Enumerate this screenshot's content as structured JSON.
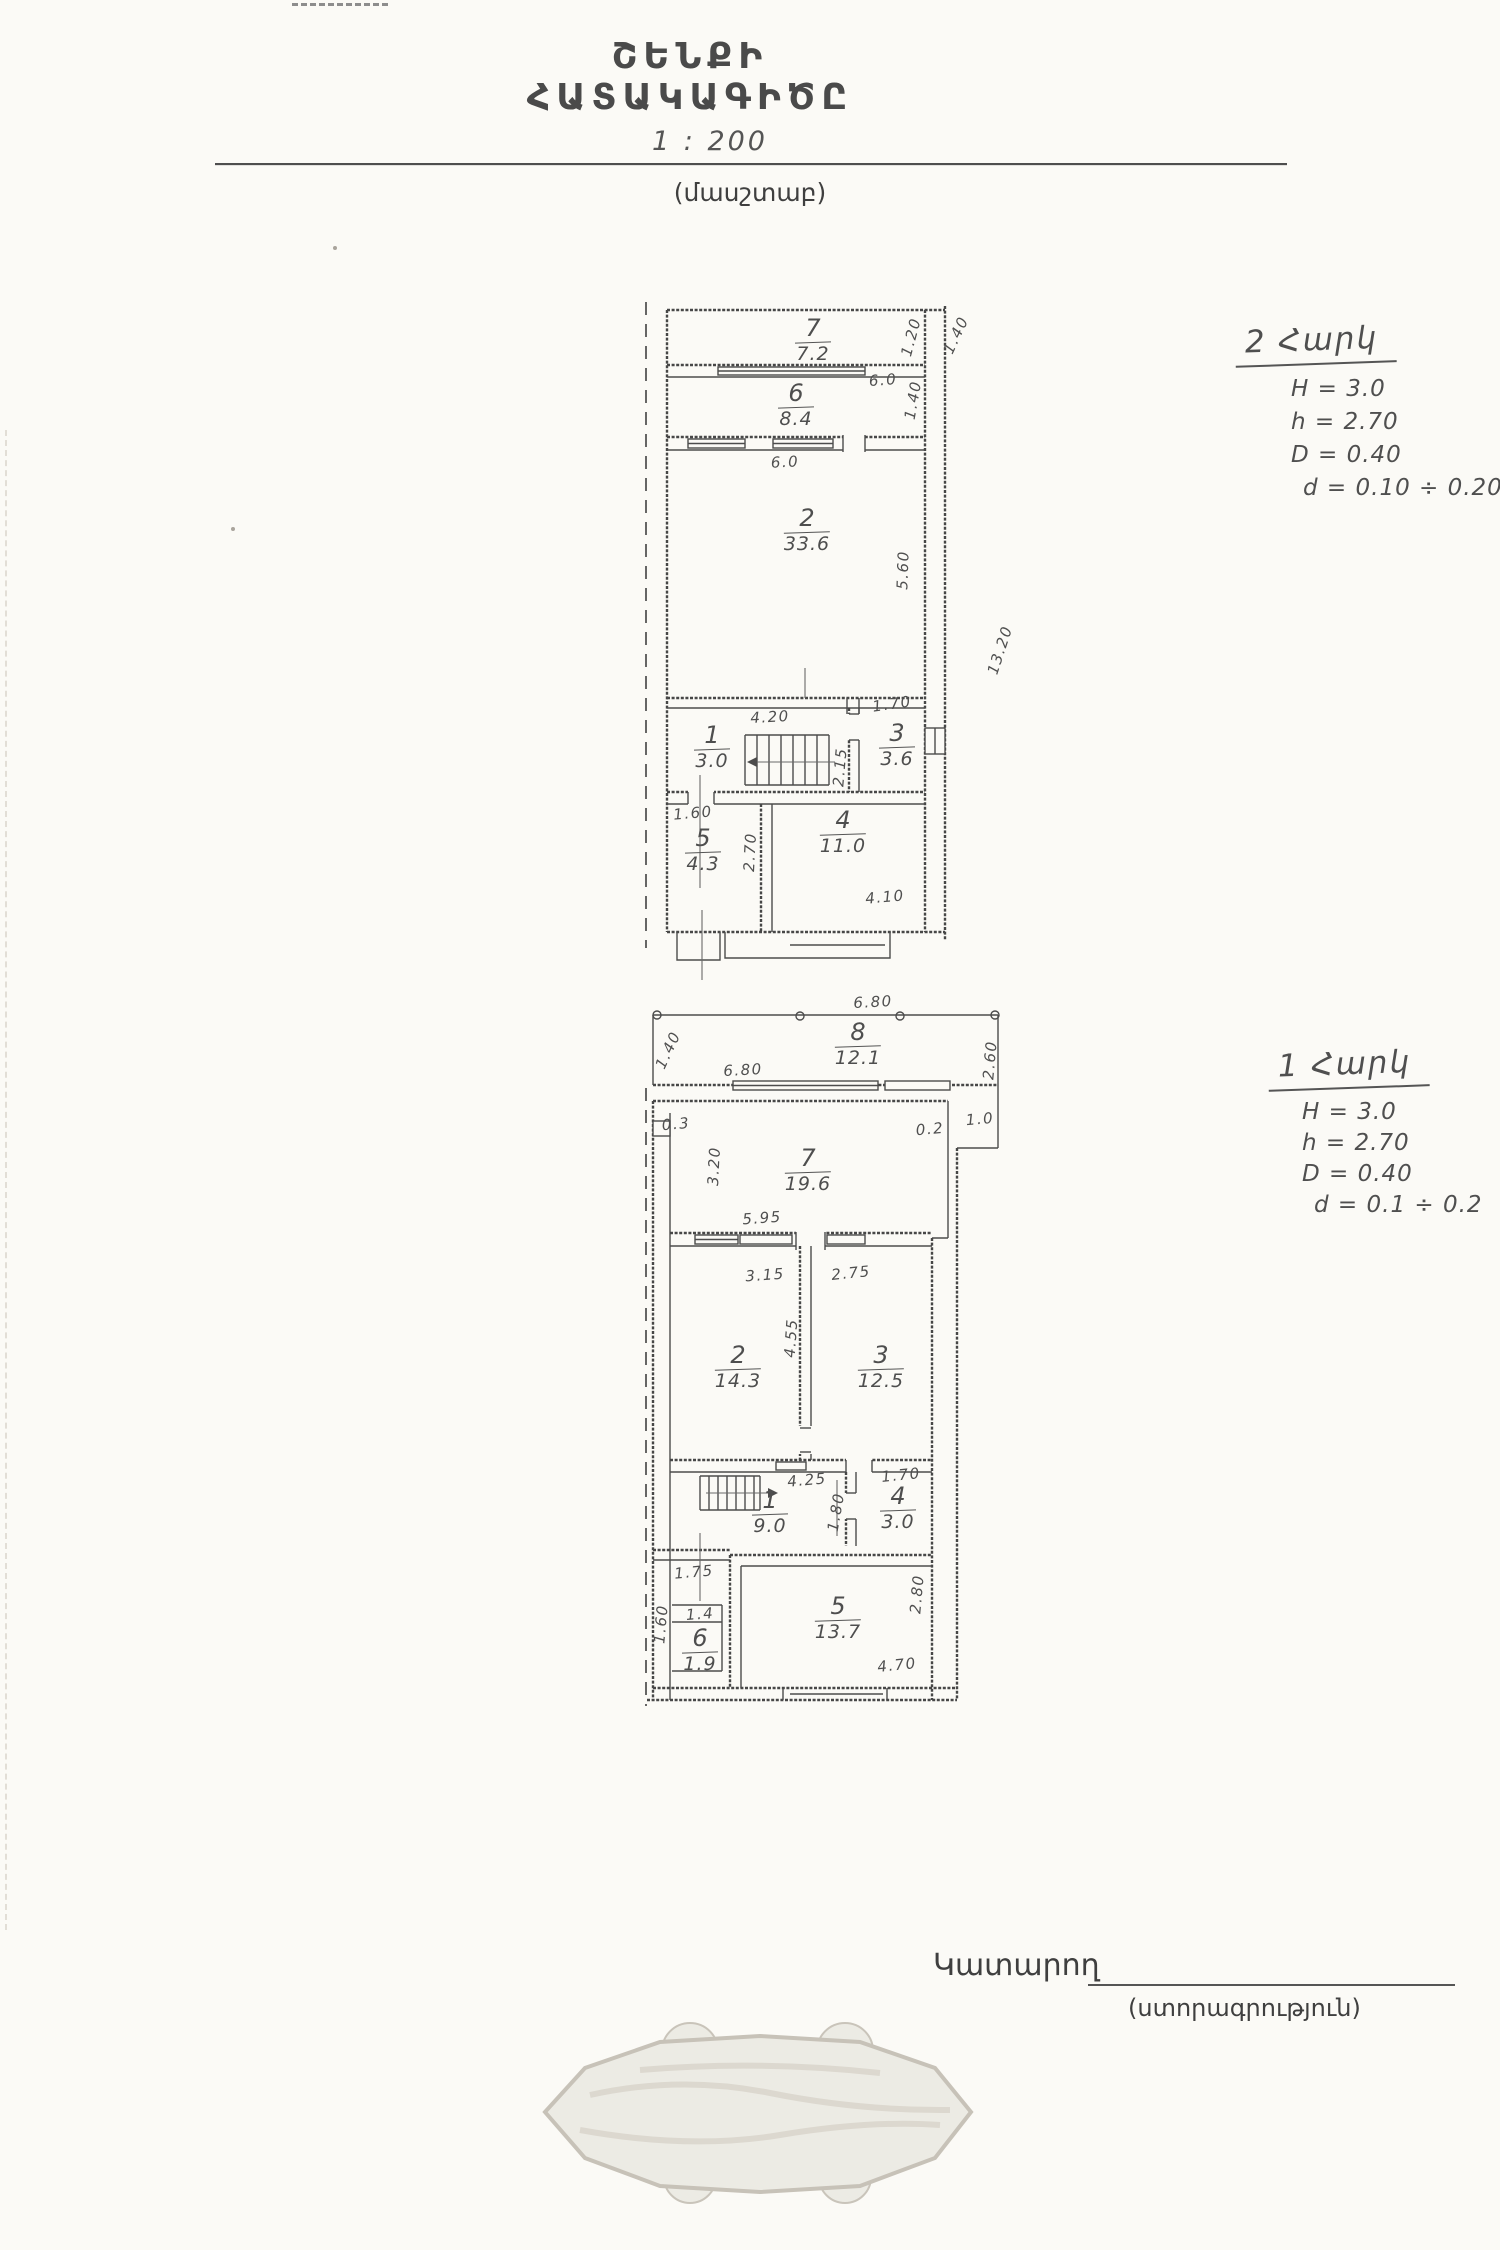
{
  "page": {
    "title": "ՇԵՆՔԻ ՀԱՏԱԿԱԳԻԾԸ",
    "scale_value": "1 : 200",
    "scale_caption": "(մասշտաբ)"
  },
  "notes": {
    "floor2": {
      "heading": "2 Հարկ",
      "lines": [
        "H = 3.0",
        "h = 2.70",
        "D = 0.40",
        "d = 0.10 ÷ 0.20"
      ]
    },
    "floor1": {
      "heading": "1 Հարկ",
      "lines": [
        "H = 3.0",
        "h = 2.70",
        "D = 0.40",
        "d = 0.1 ÷ 0.2"
      ]
    }
  },
  "plans": {
    "floor2": {
      "rooms": [
        {
          "num": "7",
          "area": "7.2",
          "x": 213,
          "y": 36
        },
        {
          "num": "6",
          "area": "8.4",
          "x": 196,
          "y": 101
        },
        {
          "num": "2",
          "area": "33.6",
          "x": 207,
          "y": 226
        },
        {
          "num": "1",
          "area": "3.0",
          "x": 112,
          "y": 443
        },
        {
          "num": "3",
          "area": "3.6",
          "x": 297,
          "y": 441
        },
        {
          "num": "5",
          "area": "4.3",
          "x": 103,
          "y": 546
        },
        {
          "num": "4",
          "area": "11.0",
          "x": 243,
          "y": 528
        }
      ],
      "dims": [
        {
          "t": "6.0",
          "x": 283,
          "y": 100,
          "r": -4
        },
        {
          "t": "6.0",
          "x": 185,
          "y": 182,
          "r": -3
        },
        {
          "t": "1.20",
          "x": 311,
          "y": 57,
          "r": -75
        },
        {
          "t": "1.40",
          "x": 313,
          "y": 120,
          "r": -80
        },
        {
          "t": "1.40",
          "x": 356,
          "y": 55,
          "r": -65
        },
        {
          "t": "5.60",
          "x": 303,
          "y": 290,
          "r": -88
        },
        {
          "t": "13.20",
          "x": 400,
          "y": 370,
          "r": -72
        },
        {
          "t": "4.20",
          "x": 170,
          "y": 437,
          "r": -3
        },
        {
          "t": "1.70",
          "x": 292,
          "y": 424,
          "r": -8
        },
        {
          "t": "2.15",
          "x": 240,
          "y": 487,
          "r": -85
        },
        {
          "t": "1.60",
          "x": 93,
          "y": 533,
          "r": -5
        },
        {
          "t": "2.70",
          "x": 150,
          "y": 572,
          "r": -87
        },
        {
          "t": "4.10",
          "x": 285,
          "y": 617,
          "r": -5
        }
      ]
    },
    "floor1": {
      "rooms": [
        {
          "num": "8",
          "area": "12.1",
          "x": 258,
          "y": 32
        },
        {
          "num": "7",
          "area": "19.6",
          "x": 208,
          "y": 158
        },
        {
          "num": "2",
          "area": "14.3",
          "x": 138,
          "y": 355
        },
        {
          "num": "3",
          "area": "12.5",
          "x": 281,
          "y": 355
        },
        {
          "num": "1",
          "area": "9.0",
          "x": 170,
          "y": 500
        },
        {
          "num": "4",
          "area": "3.0",
          "x": 298,
          "y": 496
        },
        {
          "num": "5",
          "area": "13.7",
          "x": 238,
          "y": 606
        },
        {
          "num": "6",
          "area": "1.9",
          "x": 100,
          "y": 638
        }
      ],
      "dims": [
        {
          "t": "6.80",
          "x": 273,
          "y": 14,
          "r": -3
        },
        {
          "t": "1.40",
          "x": 68,
          "y": 62,
          "r": -65
        },
        {
          "t": "2.60",
          "x": 390,
          "y": 72,
          "r": -85
        },
        {
          "t": "6.80",
          "x": 143,
          "y": 82,
          "r": -3
        },
        {
          "t": "0.3",
          "x": 76,
          "y": 136,
          "r": -5
        },
        {
          "t": "0.2",
          "x": 330,
          "y": 141,
          "r": -5
        },
        {
          "t": "1.0",
          "x": 380,
          "y": 131,
          "r": -5
        },
        {
          "t": "3.20",
          "x": 114,
          "y": 178,
          "r": -87
        },
        {
          "t": "5.95",
          "x": 162,
          "y": 230,
          "r": -4
        },
        {
          "t": "3.15",
          "x": 165,
          "y": 287,
          "r": -4
        },
        {
          "t": "2.75",
          "x": 251,
          "y": 285,
          "r": -6
        },
        {
          "t": "4.55",
          "x": 191,
          "y": 350,
          "r": -86
        },
        {
          "t": "4.25",
          "x": 207,
          "y": 492,
          "r": -5
        },
        {
          "t": "1.70",
          "x": 301,
          "y": 487,
          "r": -6
        },
        {
          "t": "1.80",
          "x": 236,
          "y": 524,
          "r": -80
        },
        {
          "t": "1.75",
          "x": 94,
          "y": 584,
          "r": -5
        },
        {
          "t": "1.60",
          "x": 61,
          "y": 636,
          "r": -85
        },
        {
          "t": "1.4",
          "x": 100,
          "y": 626,
          "r": -4
        },
        {
          "t": "2.80",
          "x": 317,
          "y": 606,
          "r": -85
        },
        {
          "t": "4.70",
          "x": 297,
          "y": 677,
          "r": -6
        }
      ]
    }
  },
  "footer": {
    "executor_label": "Կատարող",
    "signature_caption": "(ստորագրություն)"
  }
}
